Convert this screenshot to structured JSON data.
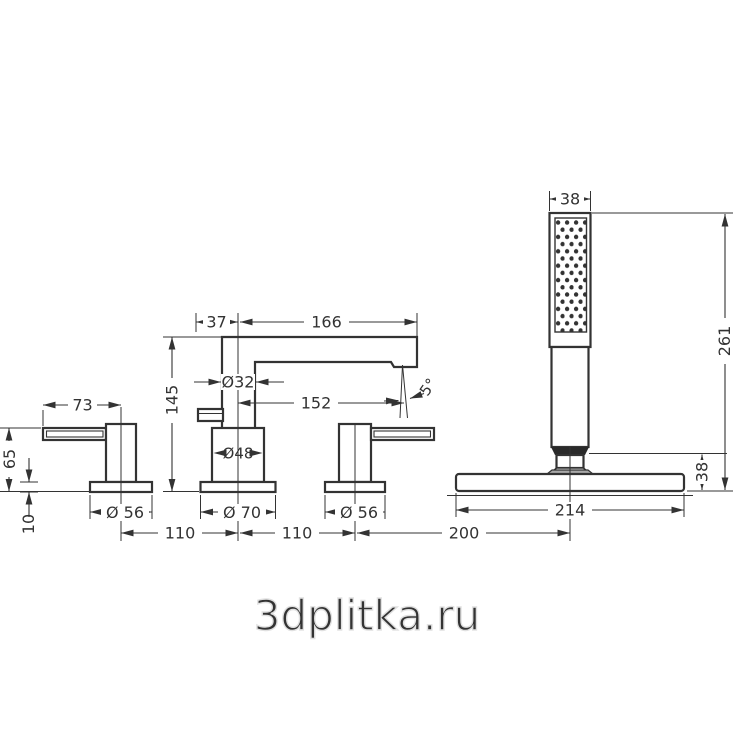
{
  "title": "bath-mixer-technical-drawing",
  "watermark": "3dplitka.ru",
  "colors": {
    "line": "#333333",
    "watermark_stroke": "#e0e0e0",
    "background": "#ffffff"
  },
  "dims": {
    "shower_head_width": "38",
    "shower_total_height": "261",
    "shower_holder_height": "38",
    "shower_plate_width": "214",
    "spout_back_offset": "37",
    "spout_reach": "166",
    "spout_pipe_diameter": "Ø32",
    "spout_aerator_reach": "152",
    "spray_angle": "5°",
    "spout_height": "145",
    "spout_body_diameter": "Ø48",
    "spout_escutcheon_diameter": "Ø 70",
    "lever_length": "73",
    "handle_height": "65",
    "escutcheon_height": "10",
    "left_escutcheon_diameter": "Ø 56",
    "right_escutcheon_diameter": "Ø 56",
    "spacing_left": "110",
    "spacing_middle": "110",
    "spacing_shower": "200"
  }
}
